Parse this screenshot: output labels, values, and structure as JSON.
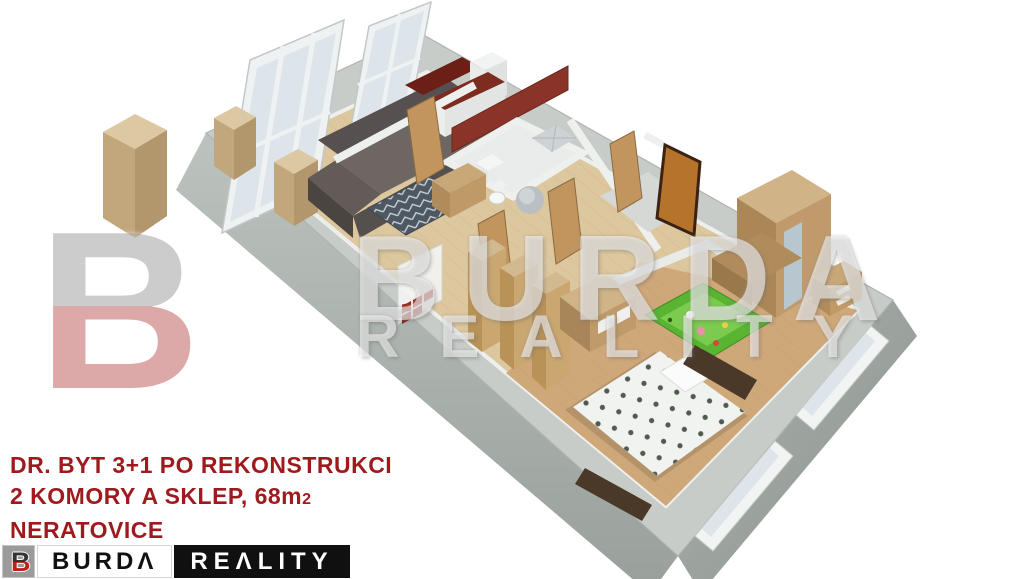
{
  "caption": {
    "line1": "DR. BYT 3+1 PO REKONSTRUKCI",
    "line2_main": "2 KOMORY A SKLEP, 68m",
    "line2_sup": "2",
    "line3": "NERATOVICE",
    "text_color": "#9e1a1d"
  },
  "logo": {
    "monogram": "B",
    "burda": "BURDΛ",
    "reality": "REΛLITY",
    "brand_red": "#c01d18",
    "brand_black": "#101010"
  },
  "watermark": {
    "monogram": "B",
    "line1": "BURDA",
    "line2": "REALITY"
  },
  "scene": {
    "type": "3d-floorplan-render",
    "rooms": [
      "living-room",
      "kitchen",
      "bathroom",
      "hallway",
      "children-room",
      "bedroom"
    ],
    "palette": {
      "outer_wall_top": "#c7ccc8",
      "outer_wall_face": "#a0a6a2",
      "floor_light": "#ddc79e",
      "floor_dark": "#cfa87a",
      "kitchen_red": "#6f2018",
      "accent_wall_red": "#8a3328",
      "sofa_gray": "#6e6663",
      "rug_slate": "#4e5862",
      "wood_furniture": "#c0a070",
      "play_rug_green": "#58b431",
      "duvet_white": "#f1f3f0",
      "door_orange": "#b5732c"
    }
  }
}
